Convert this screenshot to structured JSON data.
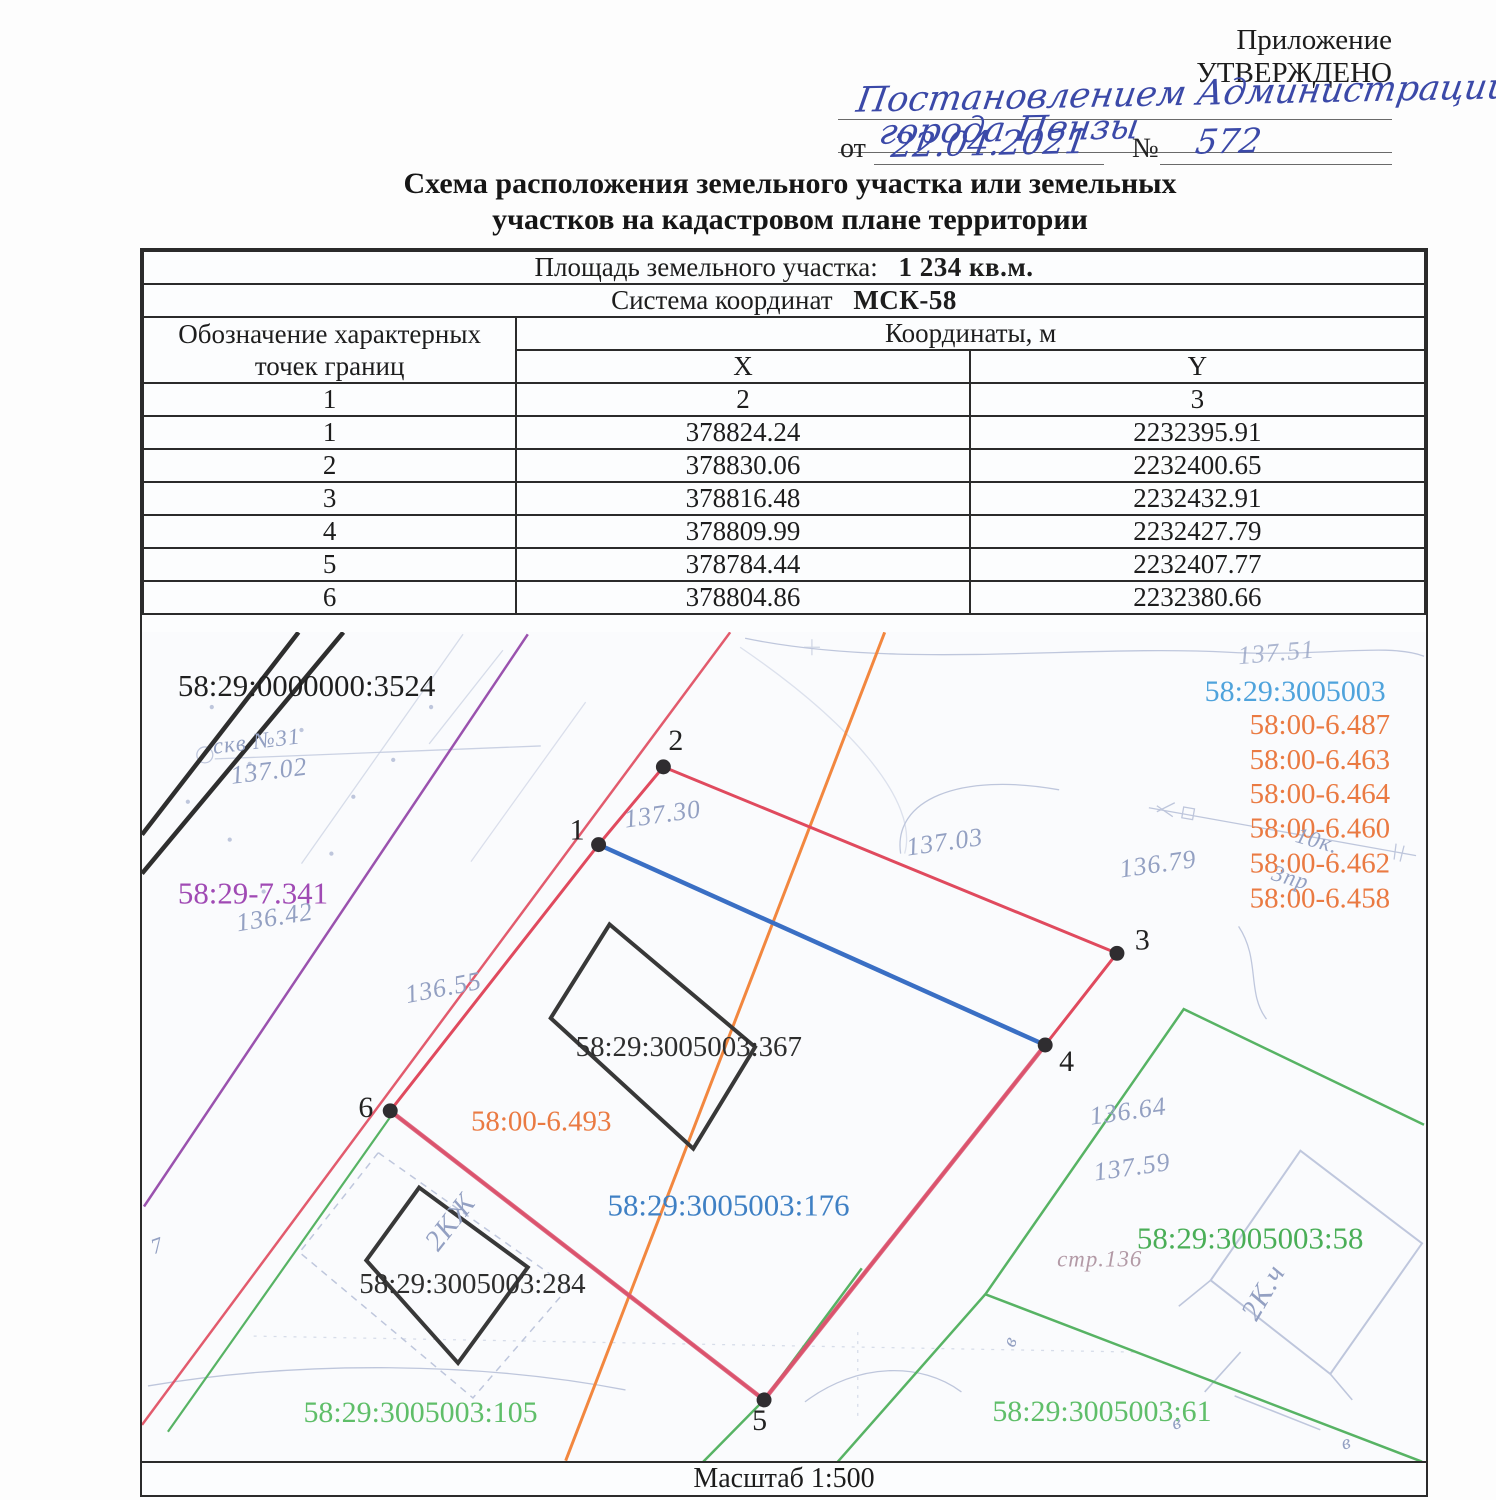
{
  "header": {
    "annex": "Приложение",
    "approved": "УТВЕРЖДЕНО",
    "hw_line1": "Постановлением Администрации",
    "hw_line2": "города Пензы",
    "from_label": "от",
    "date": "22.04.2021",
    "num_label": "№",
    "num": "572"
  },
  "title": {
    "line1": "Схема расположения земельного участка или земельных",
    "line2": "участков на кадастровом плане территории"
  },
  "info": {
    "area_label": "Площадь земельного участка:",
    "area_value": "1 234 кв.м.",
    "cs_label": "Система координат",
    "cs_value": "МСК-58"
  },
  "table": {
    "col1_header": "Обозначение характерных точек границ",
    "coords_header": "Координаты, м",
    "x_header": "X",
    "y_header": "Y",
    "index_row": [
      "1",
      "2",
      "3"
    ],
    "rows": [
      {
        "n": "1",
        "x": "378824.24",
        "y": "2232395.91"
      },
      {
        "n": "2",
        "x": "378830.06",
        "y": "2232400.65"
      },
      {
        "n": "3",
        "x": "378816.48",
        "y": "2232432.91"
      },
      {
        "n": "4",
        "x": "378809.99",
        "y": "2232427.79"
      },
      {
        "n": "5",
        "x": "378784.44",
        "y": "2232407.77"
      },
      {
        "n": "6",
        "x": "378804.86",
        "y": "2232380.66"
      }
    ]
  },
  "map": {
    "labels": {
      "q3524": "58:29:0000000:3524",
      "p7341": "58:29-7.341",
      "quarter": "58:29:3005003",
      "orange_list": [
        "58:00-6.487",
        "58:00-6.463",
        "58:00-6.464",
        "58:00-6.460",
        "58:00-6.462",
        "58:00-6.458"
      ],
      "p493": "58:00-6.493",
      "p176": "58:29:3005003:176",
      "b367": "58:29:3005003:367",
      "b284": "58:29:3005003:284",
      "p58": "58:29:3005003:58",
      "p61": "58:29:3005003:61",
      "p105": "58:29:3005003:105"
    },
    "point_labels": [
      "1",
      "2",
      "3",
      "4",
      "5",
      "6"
    ],
    "survey": {
      "skv": "скв №31",
      "v13702": "137.02",
      "v13642": "136.42",
      "v13655": "136.55",
      "v13730": "137.30",
      "v13703": "137.03",
      "v13679": "136.79",
      "v13751": "137.51",
      "v13664": "136.64",
      "v13759": "137.59",
      "str136": "стр.136",
      "k10": "10к.",
      "pr3": "3пр",
      "kzh2": "2КЖ",
      "k2": "2К.ч",
      "v7": "7",
      "b": "в"
    },
    "scale": "Масштаб 1:500",
    "colors": {
      "parcel_red": "#e04a5e",
      "section_blue": "#3a6fc4",
      "quarter_blue": "#4fa3dc",
      "parcel_text_blue": "#3f80c4",
      "orange": "#ea7a42",
      "orange_line": "#f2873f",
      "green": "#57b364",
      "green_text": "#4aae57",
      "purple": "#9a52ae",
      "ink_blue": "#3b49a8",
      "survey_gray": "#93a0c2"
    }
  }
}
